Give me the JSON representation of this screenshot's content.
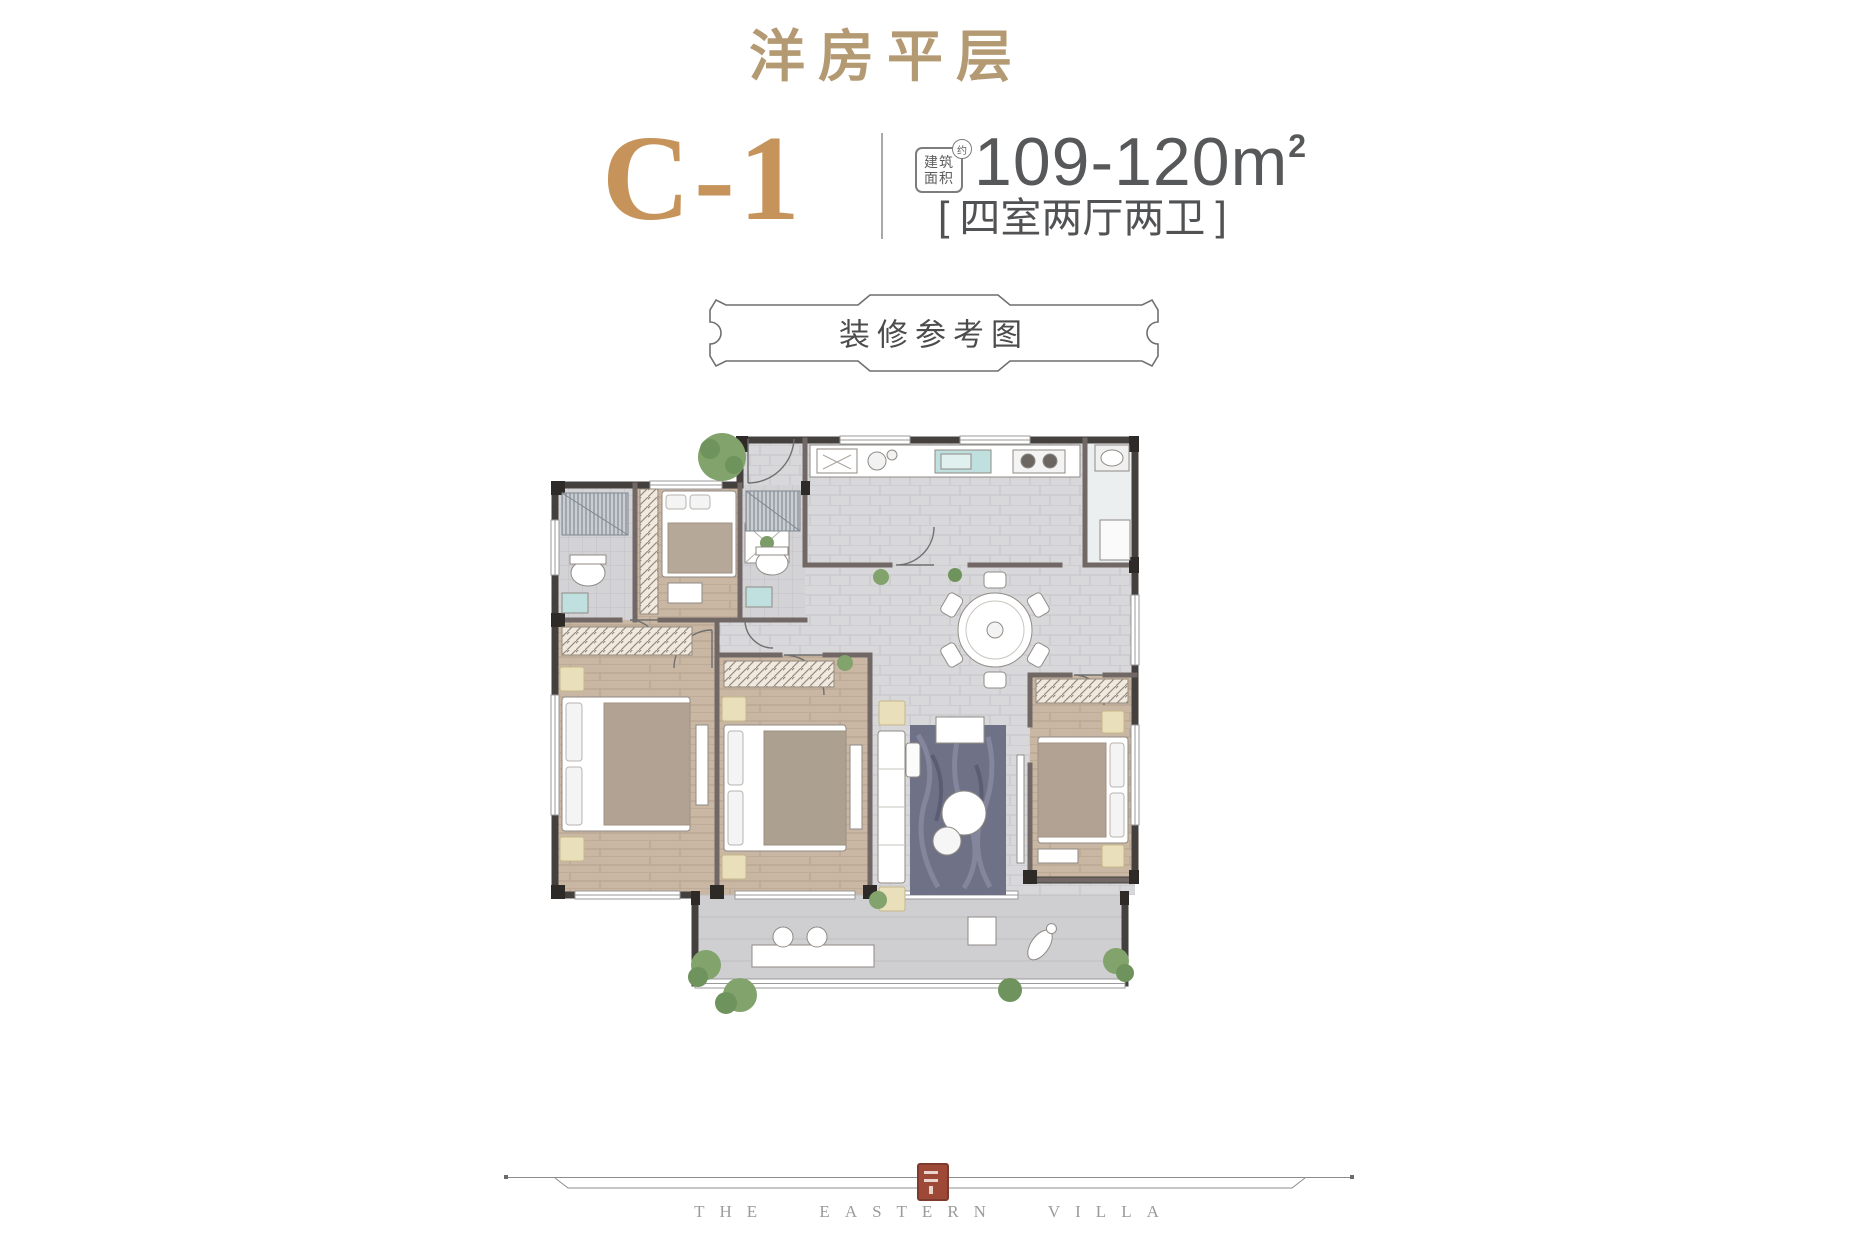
{
  "header": {
    "page_title": "洋房平层",
    "unit_code": "C-1",
    "area_badge": {
      "line1": "建筑",
      "line2": "面积",
      "approx": "约"
    },
    "area": {
      "value": "109-120",
      "unit": "m",
      "sup": "2"
    },
    "layout": {
      "open": "[",
      "text": "四室两厅两卫",
      "close": "]"
    }
  },
  "banner": {
    "label": "装修参考图"
  },
  "footer": {
    "brand": "THE EASTERN VILLA"
  },
  "colors": {
    "title_gold": "#b49a72",
    "unit_gold": "#c6935a",
    "text_dark": "#57585a",
    "banner_border": "#6f6f6f",
    "seal_red": "#9e4938",
    "wall_dark": "#44403d",
    "wall_partition": "#716865",
    "floor_tile": "#d8d8db",
    "floor_wood": "#c9b7a3",
    "rug_blue": "#6f7187",
    "plant_green": "#82a36c",
    "cushion_tan": "#e9dfba"
  }
}
